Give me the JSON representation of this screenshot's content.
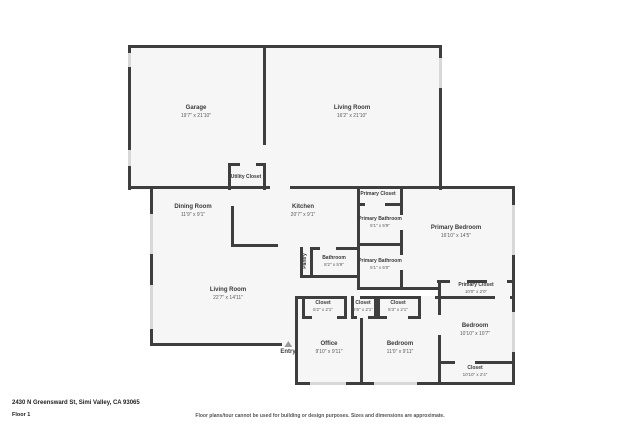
{
  "floor_plan": {
    "rooms": {
      "garage": {
        "name": "Garage",
        "dims": "19'7\" x 21'10\""
      },
      "living_room_top": {
        "name": "Living Room",
        "dims": "16'2\" x 21'10\""
      },
      "utility_closet": {
        "name": "Utility Closet"
      },
      "dining_room": {
        "name": "Dining Room",
        "dims": "11'9\" x 9'1\""
      },
      "kitchen": {
        "name": "Kitchen",
        "dims": "20'7\" x 9'1\""
      },
      "pantry": {
        "name": "Pantry"
      },
      "bathroom": {
        "name": "Bathroom",
        "dims": "8'2\" x 5'9\""
      },
      "primary_closet_top": {
        "name": "Primary Closet"
      },
      "primary_bathroom_upper": {
        "name": "Primary Bathroom",
        "dims": "5'1\" x 5'9\""
      },
      "primary_bathroom_lower": {
        "name": "Primary Bathroom",
        "dims": "5'1\" x 6'0\""
      },
      "primary_bedroom": {
        "name": "Primary Bedroom",
        "dims": "16'10\" x 14'5\""
      },
      "living_room_main": {
        "name": "Living Room",
        "dims": "22'7\" x 14'11\""
      },
      "closet_left": {
        "name": "Closet",
        "dims": "5'2\" x 2'1\""
      },
      "closet_middle": {
        "name": "Closet",
        "dims": "2'6\" x 2'1\""
      },
      "closet_right_small": {
        "name": "Closet",
        "dims": "5'3\" x 2'1\""
      },
      "office": {
        "name": "Office",
        "dims": "9'10\" x 9'11\""
      },
      "bedroom_middle": {
        "name": "Bedroom",
        "dims": "11'0\" x 9'11\""
      },
      "primary_closet_lower": {
        "name": "Primary Closet",
        "dims": "10'0\" x 2'0\""
      },
      "bedroom_right": {
        "name": "Bedroom",
        "dims": "10'10\" x 10'7\""
      },
      "closet_bottom_right": {
        "name": "Closet",
        "dims": "10'10\" x 2'4\""
      },
      "entry": {
        "name": "Entry"
      }
    },
    "footer": {
      "address": "2430 N Greensward St, Simi Valley, CA 93065",
      "floor_label": "Floor 1",
      "disclaimer": "Floor plans/tour cannot be used for building or design purposes. Sizes and dimensions are approximate."
    },
    "colors": {
      "wall": "#3e3e3e",
      "room_fill": "#f6f6f6",
      "window": "#d8d8d8",
      "label_text": "#3a3a3a",
      "dims_text": "#5a5a5a"
    }
  }
}
